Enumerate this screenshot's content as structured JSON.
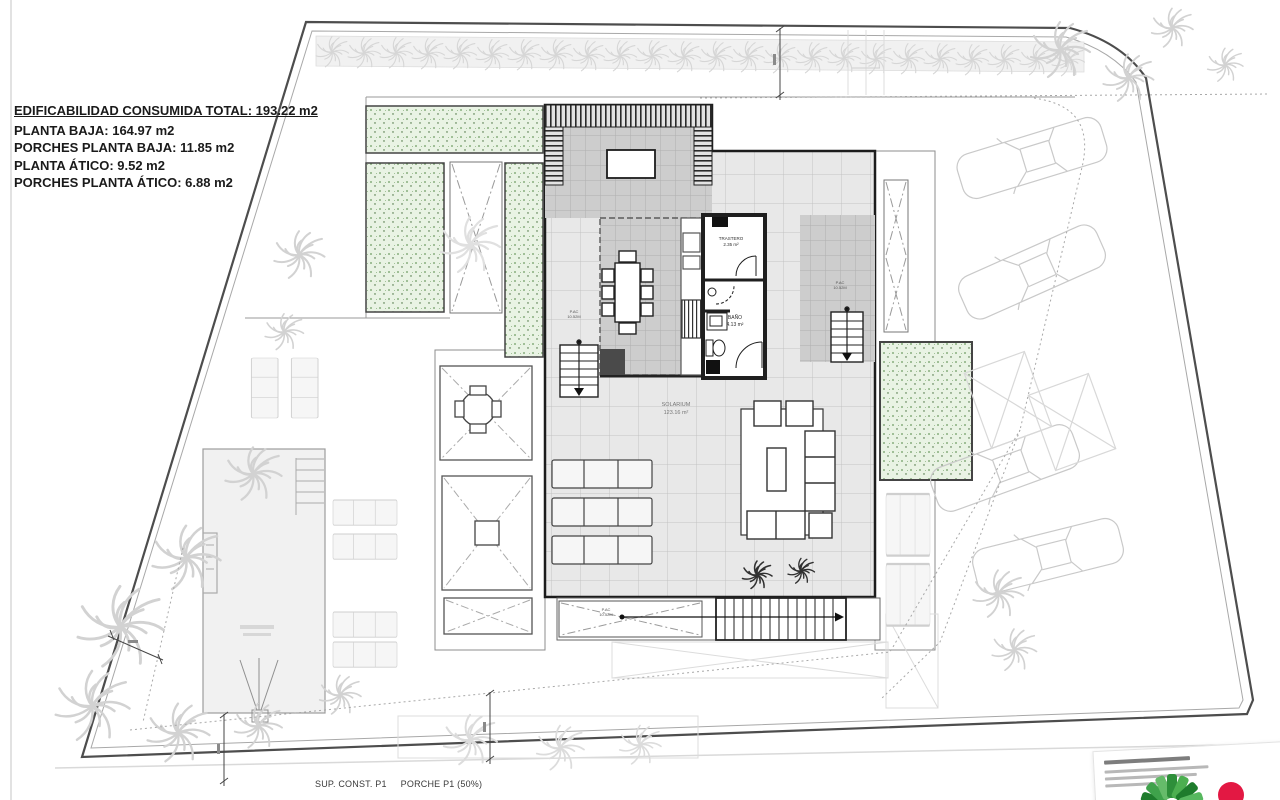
{
  "title_block": {
    "total": "EDIFICABILIDAD CONSUMIDA TOTAL: 193.22 m2",
    "items": [
      "PLANTA BAJA: 164.97 m2",
      "PORCHES PLANTA BAJA: 11.85 m2",
      "PLANTA ÁTICO: 9.52 m2",
      "PORCHES PLANTA ÁTICO: 6.88 m2"
    ]
  },
  "rooms": {
    "solarium": {
      "name": "SOLARIUM",
      "area": "123.16 m²"
    },
    "trastero": {
      "name": "TRASTERO",
      "area": "2.35 m²"
    },
    "bano": {
      "name": "BAÑO",
      "area": "4.13 m²"
    }
  },
  "annotations": {
    "pac": {
      "line1": "P.AC",
      "line2": "10.52M"
    }
  },
  "footer": {
    "sup_const": "SUP. CONST. P1",
    "porche": "PORCHE P1 (50%)"
  },
  "colors": {
    "boundary": "#4d4d4d",
    "wall": "#1f1f1f",
    "deck_tile_bg": "#e8e8e8",
    "atico_tile_bg": "#cdcdcd",
    "garden_fill": "#e9f3e4",
    "garden_dot": "#5c8f52",
    "palm_gray": "#d2d2d2",
    "logo_red": "#e31843",
    "logo_green": "#2f8f3c"
  }
}
